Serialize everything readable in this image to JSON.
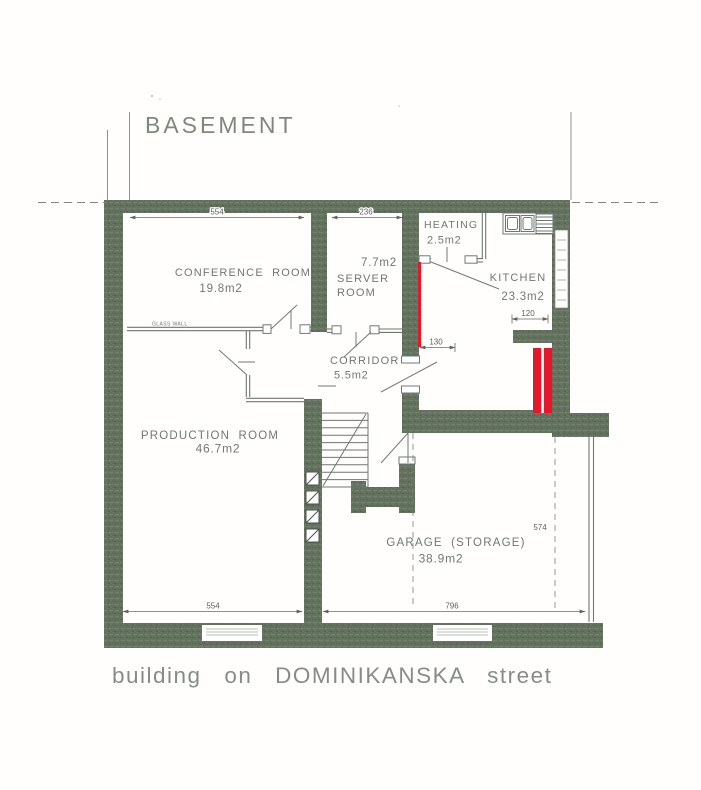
{
  "plan": {
    "title": "BASEMENT",
    "caption": "building on DOMINIKANSKA street",
    "rooms": {
      "conference": {
        "name": "CONFERENCE ROOM",
        "area": "19.8m2"
      },
      "server": {
        "area": "7.7m2",
        "name_line1": "SERVER",
        "name_line2": "ROOM"
      },
      "heating": {
        "name": "HEATING",
        "area": "2.5m2"
      },
      "kitchen": {
        "name": "KITCHEN",
        "area": "23.3m2"
      },
      "corridor": {
        "name": "CORRIDOR",
        "area": "5.5m2"
      },
      "production": {
        "name": "PRODUCTION ROOM",
        "area": "46.7m2"
      },
      "garage": {
        "name": "GARAGE (STORAGE)",
        "area": "38.9m2"
      }
    },
    "dimensions": {
      "conference_width": "554",
      "server_width": "236",
      "kitchen_niche": "120",
      "kitchen_door": "130",
      "garage_depth": "574",
      "production_width": "554",
      "garage_width": "796"
    },
    "annotations": {
      "glass_wall": "GLASS WALL"
    },
    "colors": {
      "wall_fill": "#64735f",
      "highlight_red": "#e4182b",
      "ink": "#6e7971"
    }
  }
}
